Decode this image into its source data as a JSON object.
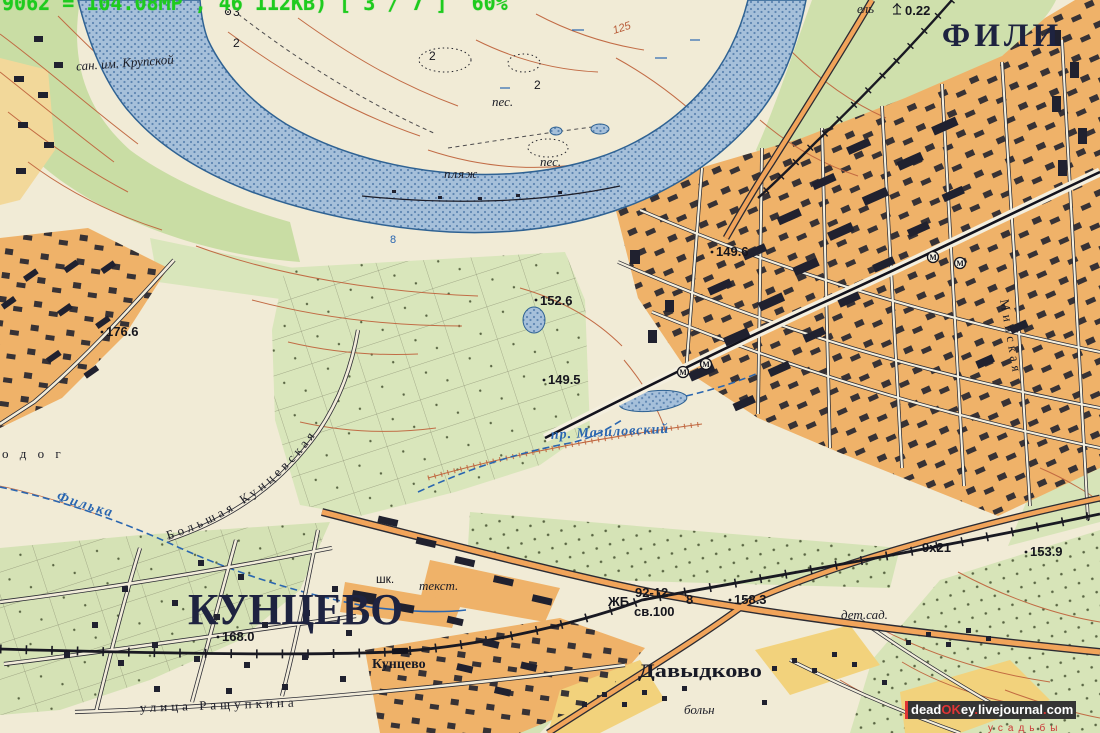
{
  "viewer_overlay": {
    "status_text": "9062 = 104.08MP , 46 112KB) [ 3 / 7 ]  60%"
  },
  "watermark": {
    "p_dead": "dead",
    "p_ok": "OK",
    "p_ey": "ey",
    "p_dot1": ".",
    "p_journal": "livejournal",
    "p_dot2": ".",
    "p_com": "com"
  },
  "labels": {
    "fili": "ФИЛИ",
    "kuntsevo": "КУНЦЕВО",
    "davydkovo": "Давыдково",
    "san_krupskoy": "сан. им. Крупской",
    "plyazh": "пляж",
    "pes": "пес.",
    "pes2": "пес.",
    "filka": "Филька",
    "mazilovsky": "пр. Мазиловский",
    "bolshaya_kuntsevskaya": "Большая Кунцевская",
    "rashchupkina": "улица Ращупкина",
    "minskaya": "Минская",
    "odog": "о д о г",
    "station_kuntsevo": "Кунцево",
    "shkola": "шк.",
    "tekstil": "текст.",
    "detsad": "дет.сад.",
    "bolnitsa": "больн",
    "usadby": "усадьбы",
    "el": "ель",
    "el_height": "0.22",
    "zhb": "ЖБ",
    "bridge_num": "92-12",
    "bridge_clearance": "св.100",
    "bridge_width": "8",
    "road_spec": "9х21",
    "river_depth": "8",
    "metro_m": "М"
  },
  "elevations": {
    "e176_6": "176.6",
    "e152_6": "152.6",
    "e149_5": "149.5",
    "e149_6": "149.6",
    "e168_0": "168.0",
    "e158_3": "158.3",
    "e153_9": "153.9"
  },
  "contours": {
    "c125": "125",
    "c2_a": "2",
    "c2_b": "2",
    "c2_c": "2",
    "c3": "3"
  },
  "colors": {
    "paper": "#f1ebd6",
    "greenery": "#cfdfab",
    "urban_orange": "#efb269",
    "village_yellow": "#f2d27c",
    "river_blue": "#9db9d5",
    "hydro_blue": "#2a66b0",
    "contour_brown": "#c0663f",
    "ink_navy": "#1e2340",
    "overlay_green": "#1ecb1e",
    "watermark_red": "#e03535",
    "watermark_bg": "#353535"
  }
}
